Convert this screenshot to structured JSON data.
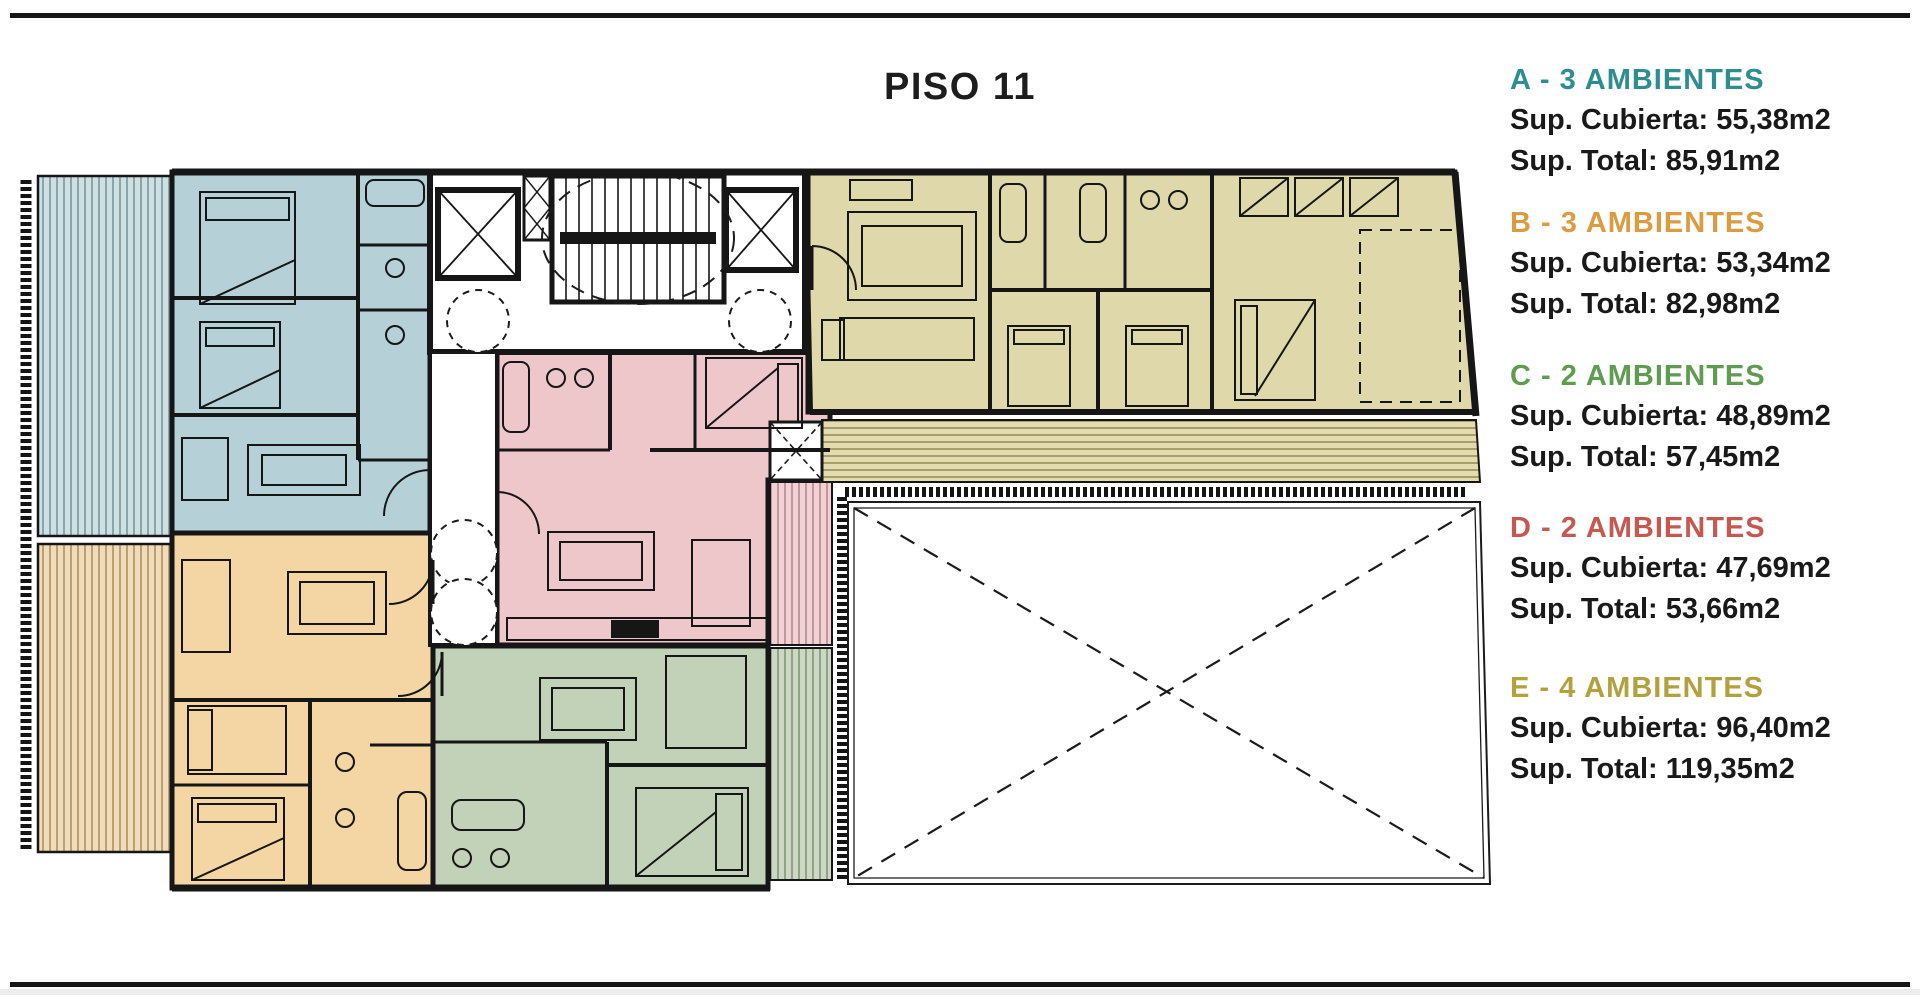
{
  "title": "PISO 11",
  "legend": [
    {
      "id": "A",
      "label": "A - 3 AMBIENTES",
      "color": "#2e8d8f",
      "cubierta": "Sup. Cubierta: 55,38m2",
      "total": "Sup. Total: 85,91m2"
    },
    {
      "id": "B",
      "label": "B - 3 AMBIENTES",
      "color": "#db9b41",
      "cubierta": "Sup. Cubierta: 53,34m2",
      "total": "Sup. Total: 82,98m2"
    },
    {
      "id": "C",
      "label": "C - 2 AMBIENTES",
      "color": "#5f9c51",
      "cubierta": "Sup. Cubierta: 48,89m2",
      "total": "Sup. Total: 57,45m2"
    },
    {
      "id": "D",
      "label": "D - 2 AMBIENTES",
      "color": "#c65852",
      "cubierta": "Sup. Cubierta: 47,69m2",
      "total": "Sup. Total: 53,66m2"
    },
    {
      "id": "E",
      "label": "E - 4 AMBIENTES",
      "color": "#b2a23f",
      "cubierta": "Sup. Cubierta: 96,40m2",
      "total": "Sup. Total: 119,35m2"
    }
  ],
  "plan": {
    "wall_color": "#161616",
    "units": {
      "A": {
        "fill": "#b5d0d6"
      },
      "B": {
        "fill": "#f4d6a4"
      },
      "C": {
        "fill": "#c2d2b8"
      },
      "D": {
        "fill": "#eec7ca"
      },
      "E": {
        "fill": "#ded8ab"
      }
    },
    "balconies": {
      "A": {
        "fill": "#cfdfe2"
      },
      "B": {
        "fill": "#eedcbc"
      },
      "C": {
        "fill": "#ccd8c3"
      },
      "D": {
        "fill": "#f0d2d4"
      },
      "E": {
        "fill": "#e3dcb2"
      }
    }
  }
}
